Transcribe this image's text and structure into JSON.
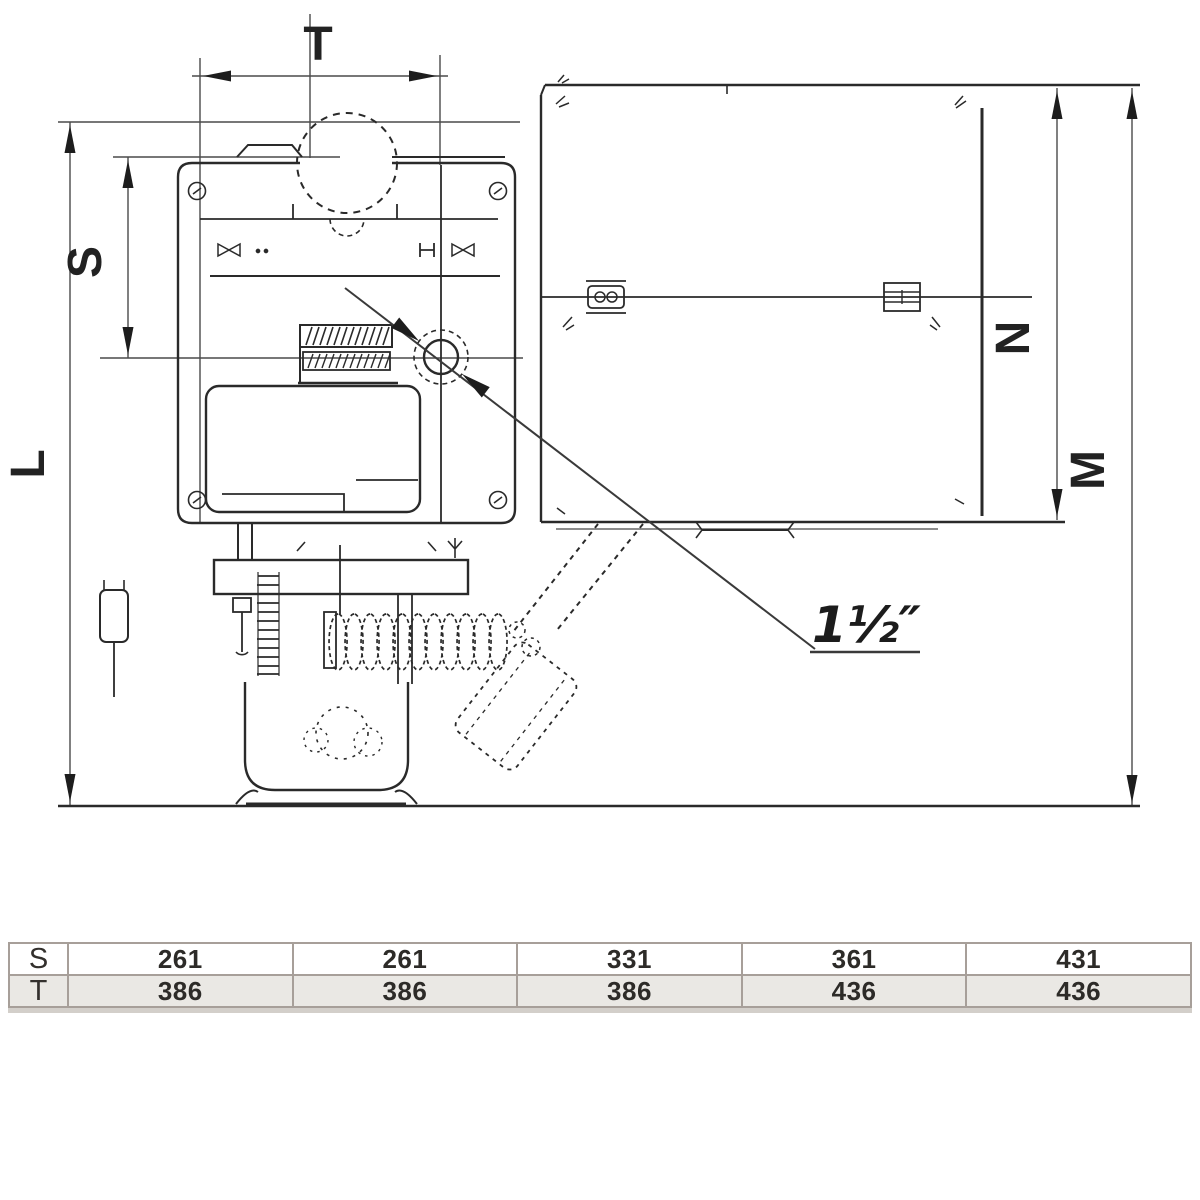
{
  "drawing": {
    "dim_labels": {
      "t": "T",
      "s": "S",
      "l": "L",
      "n": "N",
      "m": "M"
    },
    "annotation": {
      "connection_size": "1½″"
    },
    "colors": {
      "line": "#2e2e2e",
      "dim_line": "#4a4a4a",
      "arrow": "#1d1d1d",
      "table_border": "#a79f99",
      "table_row_alt_bg": "#eae8e4",
      "table_text": "#2d2b28"
    }
  },
  "table": {
    "rows": [
      {
        "label": "S",
        "values": [
          "261",
          "261",
          "331",
          "361",
          "431"
        ]
      },
      {
        "label": "T",
        "values": [
          "386",
          "386",
          "386",
          "436",
          "436"
        ]
      }
    ]
  }
}
